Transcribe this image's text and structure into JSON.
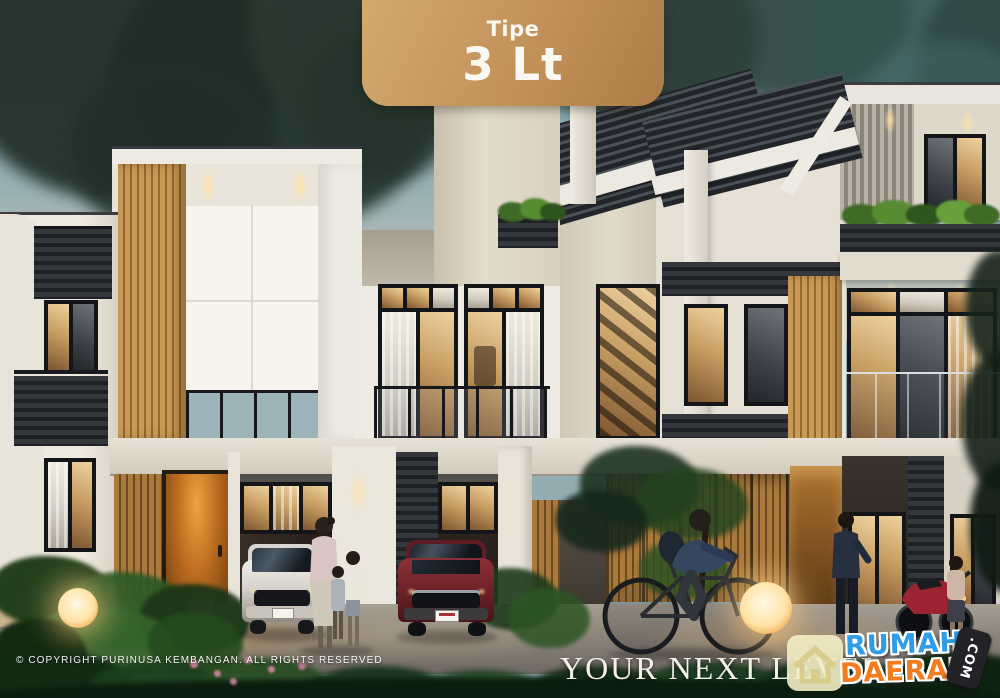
{
  "badge": {
    "line1": "Tipe",
    "line2": "3 Lt"
  },
  "footer": {
    "copyright": "© COPYRIGHT PURINUSA KEMBANGAN. ALL RIGHTS RESERVED",
    "tagline": "YOUR NEXT LEVEL"
  },
  "logo": {
    "word_top": "RUMAH",
    "word_bottom": "DAERAH",
    "tld": ".COM"
  },
  "colors": {
    "badge_gold": "#c2915a",
    "logo_blue": "#2f9ce8",
    "logo_orange": "#f27c1e",
    "sky_teal": "#7fa3ad",
    "wood_tan": "#c0914e",
    "roof_dark": "#33383c"
  }
}
